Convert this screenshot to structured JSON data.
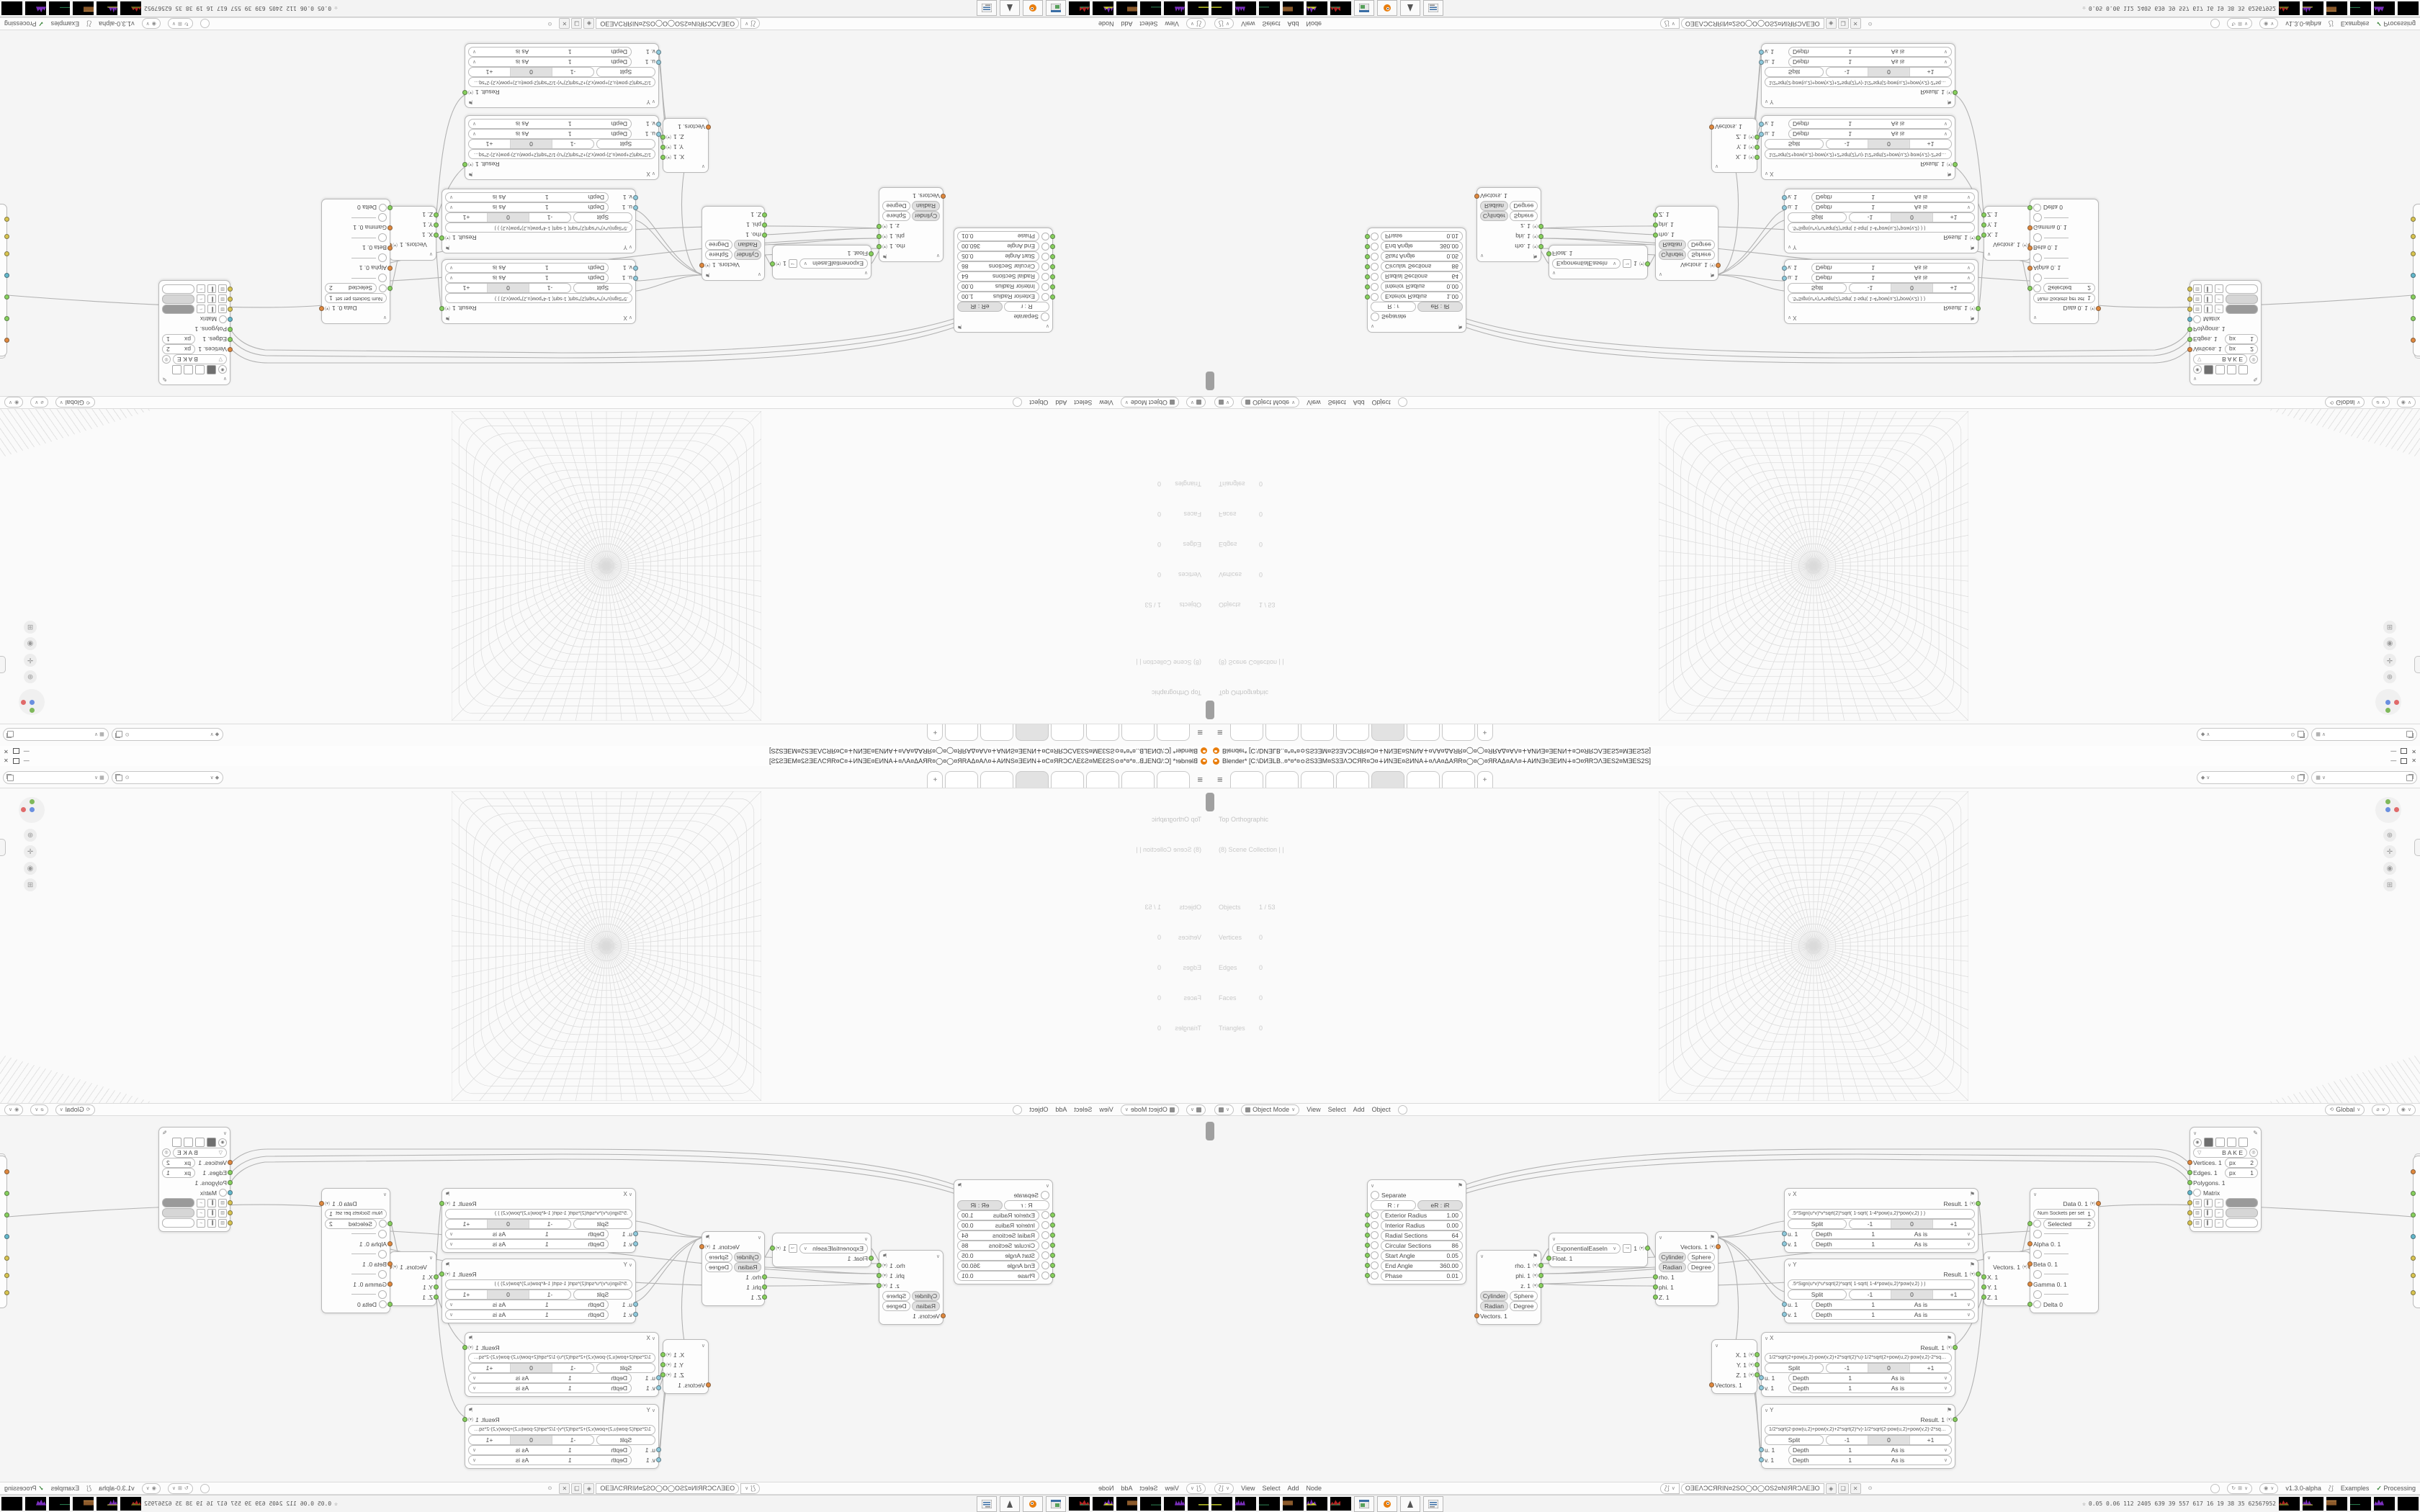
{
  "window": {
    "title": "Blender* [C:\\DИƎLB..¤*¤*¤≎ƧS3ƎM¤S3ƎΛƆCЯR¤Ɔ¤∔ИNƎE¤ƧИNA∔¤ΛA¤ΔAЯR¤◯¤◯¤ЯRAΔ¤AΛ¤∔AИNƎ¤ƎEИN∔¤Ɔ¤ЯRƆΛƎES2¤MƎES2S]",
    "minimize": "—",
    "close": "✕"
  },
  "topbar": {
    "menu_icon": "≡",
    "add_tab": "+"
  },
  "viewport": {
    "view_label": "Top Orthographic",
    "collection_label": "(8) Scene Collection | |",
    "stats": {
      "objects_label": "Objects",
      "objects_value": "1 / 53",
      "vertices_label": "Vertices",
      "vertices_value": "0",
      "edges_label": "Edges",
      "edges_value": "0",
      "faces_label": "Faces",
      "faces_value": "0",
      "triangles_label": "Triangles",
      "triangles_value": "0"
    },
    "tools": [
      "⊕",
      "✛",
      "◉",
      "⊞"
    ]
  },
  "vp_header": {
    "mode": "Object Mode",
    "menus": [
      "View",
      "Select",
      "Add",
      "Object"
    ],
    "orientation": "Global"
  },
  "ne_header": {
    "menus": [
      "View",
      "Select",
      "Add",
      "Node"
    ],
    "tree_name": "OƎEΛƆCЯRIN¤2SO◯O◯OS2¤NIЯRƆΛEƎO",
    "version": "v1.3.0-alpha",
    "examples": "Examples",
    "check": "✓",
    "processing": "Processing"
  },
  "nodes": {
    "torus": {
      "separate": "Separate",
      "modes": [
        "R : r",
        "eR : iR"
      ],
      "params": [
        {
          "label": "Exterior Radius",
          "value": "1.00"
        },
        {
          "label": "Interior Radius",
          "value": "0.00"
        },
        {
          "label": "Radial Sections",
          "value": "64"
        },
        {
          "label": "Circular Sections",
          "value": "86"
        },
        {
          "label": "Start Angle",
          "value": "0.05"
        },
        {
          "label": "End Angle",
          "value": "360.00"
        },
        {
          "label": "Phase",
          "value": "0.01"
        }
      ]
    },
    "polar_out": {
      "outputs": [
        "rho. 1",
        "phi. 1",
        "z. 1"
      ],
      "toggles1": [
        "Cylinder",
        "Sphere"
      ],
      "toggles2": [
        "Radian",
        "Degree"
      ],
      "input": "Vectors. 1"
    },
    "easing": {
      "mode": "ExponentialEaseIn",
      "value": "1",
      "input": "Float. 1"
    },
    "polar_in": {
      "output": "Vectors. 1",
      "toggles1": [
        "Cylinder",
        "Sphere"
      ],
      "toggles2": [
        "Radian",
        "Degree"
      ],
      "inputs": [
        "rho. 1",
        "phi. 1",
        "Z. 1"
      ]
    },
    "vector_out": {
      "outputs": [
        "X. 1",
        "Y. 1",
        "Z. 1"
      ],
      "input": "Vectors. 1"
    },
    "vector_in": {
      "output": "Vectors. 1",
      "inputs": [
        "X. 1",
        "Y. 1",
        "Z. 1"
      ]
    },
    "formulas": [
      {
        "label": "X",
        "result": "Result. 1",
        "formula": ".5*Sign(u*v)*v*sqrt(2)*sqrt( 1-sqrt( 1-4*pow(u,2)*pow(v,2) ) )",
        "split": "Split",
        "segments": [
          "-1",
          "0",
          "+1"
        ],
        "in1": "u. 1",
        "in2": "v. 1",
        "depth": "Depth",
        "depth_val": "1",
        "asis": "As is"
      },
      {
        "label": "Y",
        "result": "Result. 1",
        "formula": ".5*Sign(u*v)*u*sqrt(2)*sqrt( 1-sqrt( 1-4*pow(u,2)*pow(v,2) ) )",
        "split": "Split",
        "segments": [
          "-1",
          "0",
          "+1"
        ],
        "in1": "u. 1",
        "in2": "v. 1",
        "depth": "Depth",
        "depth_val": "1",
        "asis": "As is"
      },
      {
        "label": "X",
        "result": "Result. 1",
        "formula": "1/2*sqrt(2+pow(u,2)-pow(v,2)+2*sqrt(2)*u)-1/2*sqrt(2+pow(u,2)-pow(v,2)-2*sqrt(2)*u)",
        "split": "Split",
        "segments": [
          "-1",
          "0",
          "+1"
        ],
        "in1": "u. 1",
        "in2": "v. 1",
        "depth": "Depth",
        "depth_val": "1",
        "asis": "As is"
      },
      {
        "label": "Y",
        "result": "Result. 1",
        "formula": "1/2*sqrt(2-pow(u,2)+pow(v,2)+2*sqrt(2)*v)-1/2*sqrt(2-pow(u,2)+pow(v,2)-2*sqrt(2)*v)",
        "split": "Split",
        "segments": [
          "-1",
          "0",
          "+1"
        ],
        "in1": "u. 1",
        "in2": "v. 1",
        "depth": "Depth",
        "depth_val": "1",
        "asis": "As is"
      }
    ],
    "switch": {
      "output": "Data 0. 1",
      "num_label": "Num Sockets per set",
      "num_value": "1",
      "selected_label": "Selected",
      "selected_value": "2",
      "items": [
        "Alpha 0. 1",
        "Beta 0. 1",
        "Gamma 0. 1",
        "Delta 0"
      ]
    },
    "viewer": {
      "bake": "B A K E",
      "inputs": [
        {
          "label": "Vertices. 1",
          "px_label": "px",
          "px_value": "2"
        },
        {
          "label": "Edges. 1",
          "px_label": "px",
          "px_value": "1"
        },
        {
          "label": "Polygons. 1"
        },
        {
          "label": "Matrix"
        }
      ],
      "swatches": [
        "#9a9a9a",
        "#d6d6d6",
        "#ffffff"
      ]
    }
  },
  "taskbar": {
    "tray_icon": "☆",
    "tray_text": "0.05 0.06 112 2405 639  39  557 617  16  19  38  35 62567952"
  },
  "colors": {
    "accent_orange": "#e87d0d",
    "socket_green": "#86d05c",
    "socket_orange": "#e0883c",
    "socket_cyan": "#62b8cc",
    "socket_yellow": "#d8c44f"
  }
}
